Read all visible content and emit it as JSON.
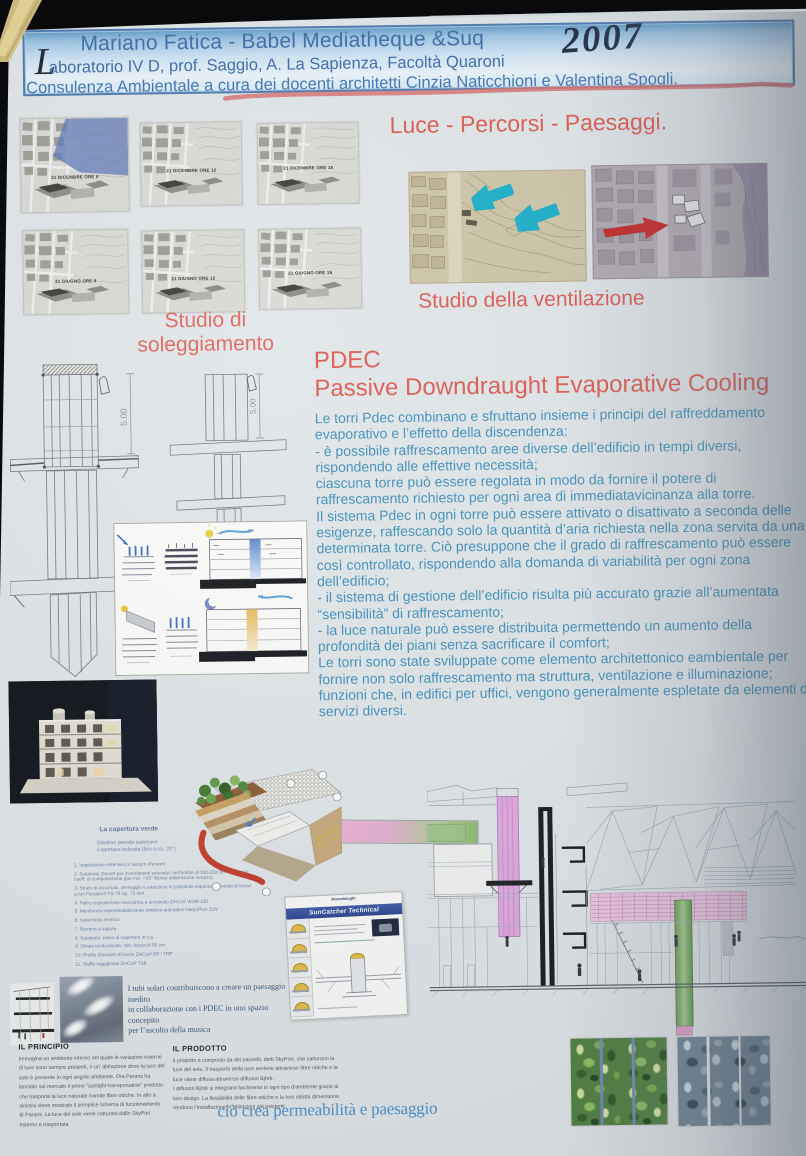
{
  "header": {
    "title_line": "Mariano Fatica - Babel Mediatheque &Suq",
    "lab_line_initial": "L",
    "lab_line_rest": "aboratorio IV D, prof. Saggio, A. La Sapienza, Facoltà Quaroni",
    "year_handwritten": "2007",
    "consulting_line": "Consulenza Ambientale a cura dei docenti architetti Cinzia Naticchioni e Valentina Spogli."
  },
  "light_section": {
    "title": "Luce - Percorsi - Paesaggi."
  },
  "sun_study": {
    "caption": "Studio di soleggiamento",
    "panels": [
      {
        "label": "21 DICEMBRE ORE 9"
      },
      {
        "label": "21 DICEMBRE ORE 12"
      },
      {
        "label": "21 DICEMBRE ORE 15"
      },
      {
        "label": "21 GIUGNO ORE 9"
      },
      {
        "label": "21 GIUGNO ORE 12"
      },
      {
        "label": "21 GIUGNO ORE 16"
      }
    ]
  },
  "ventilation": {
    "caption": "Studio della ventilazione"
  },
  "pdec": {
    "acronym": "PDEC",
    "title": "Passive Downdraught Evaporative Cooling",
    "body": "Le torri Pdec combinano e sfruttano insieme i principi del raffreddamento evaporativo e l’effetto della discendenza:\n- è possibile raffrescamento aree diverse dell’edificio in tempi diversi, rispondendo alle effettive necessità;\nciascuna torre può essere regolata in modo da fornire il potere di raffrescamento richiesto per ogni area di immediatavicinanza alla torre.\nIl sistema Pdec in ogni torre può essere attivato o disattivato a seconda delle esigenze, raffescando solo la quantità d’aria richiesta nella zona servita da una determinata torre. Ciò presuppone che il grado di raffrescamento può essere così controllato, rispondendo alla domanda di variabilità per ogni zona dell’edificio;\n- il sistema di gestione dell’edificio risulta più accurato grazie all’aumentata “sensibilità” di raffrescamento;\n- la luce naturale può essere distribuita permettendo un aumento della profondità dei piani senza sacrificare il comfort;\nLe torri sono state sviluppate come elemento architettonico eambientale per fornire non solo raffrescamento ma struttura, ventilazione e illuminazione; funzioni che, in edifici per uffici, vengono generalmente espletate da elementi di servizi diversi."
  },
  "towers": {
    "dimension_label": "5.00"
  },
  "model_photo": {
    "caption_line1": "Office Building, Catania, Italy,",
    "caption_line2": "by Mario Cucinella Architects"
  },
  "green_roof": {
    "title": "La copertura verde",
    "subtitle": "Giardino pensile estensivo\nCopertura inclinata (fino a ca. 20°)",
    "items": [
      "1. Vegetazione estensiva a Sedum /Perenni",
      "2. Substrato Zinco® per inverdimenti estensivi, nell’ordine di 100-150 l/m² compreso coeff. di compattazione (per incl. >15° Bioree antierosione Grepito)",
      "3. Strato di accumulo, drenaggio e areazione in polistirolo espanso provvisto di incavi e fori Floratec® FS 75 Sp. 75 mm",
      "4. Feltro di protezione meccanica e accumulo ZinCo® WSM 150",
      "5. Membrana impermeabilizzante sintetica antiradice HarpoPlan ZUV",
      "6. Isolamento termico",
      "7. Barriera a vapore",
      "8. Substrato: piano di copertura in c.a.",
      "9. Ghiaia tonda lavata, min. fascia di 50 cm",
      "10. Profilo drenante di bordo ZinCo® DP / TRP",
      "11. Staffa reggighiaia ZinCo® TS8"
    ]
  },
  "suncatcher": {
    "brand": "Monodraught",
    "title": "SunCatcher Technical"
  },
  "solar_note": "I tubi solari contribuiscono a creare un paesaggio inedito\nin collaborazione con i PDEC in uno spazio concepito\nper l’ascolto della musica",
  "principle": {
    "title": "IL PRINCIPIO",
    "body": "Immagina un ambiente interno nel quale le variazioni esterne di luce sono sempre presenti, o un’ abitazione dove la luce del sole è presente in ogni angolo ambiente. Ora Parans ha lanciato sul mercato il primo “sunlight-transportation” prodotto che trasporta la luce naturale tramite fibre ottiche. In alto a sinistra viene mostrato il semplice schema di funzionamento di Parans. La luce del sole viene catturata dallo SkyPort esterno e trasportata"
  },
  "product": {
    "title": "IL PRODOTTO",
    "body": "Il prodotto è composto da dei pannelli, detti SkyPort, che catturano la luce del sole. Il trasporto della luce avviene attraverso fibre ottiche e la luce viene diffusa attraverso diffusori Björk.\nI diffusori Björk si integrano facilmente in ogni tipo d’ambiente grazie al loro design. La flessibilità delle fibre ottiche e la loro ridotta dimensione rendono l’installazione in abitazioni già esistenti"
  },
  "permeability_caption": "ciò crea permeabilità e paesaggio",
  "colors": {
    "accent_red": "#dd5a50",
    "body_blue": "#4090ba",
    "header_blue": "#3a6aa6",
    "wind_cyan": "#18aec8",
    "wind_red": "#c52222",
    "pdec_pink": "#e0a8e0",
    "tower_green": "#7ab060"
  }
}
